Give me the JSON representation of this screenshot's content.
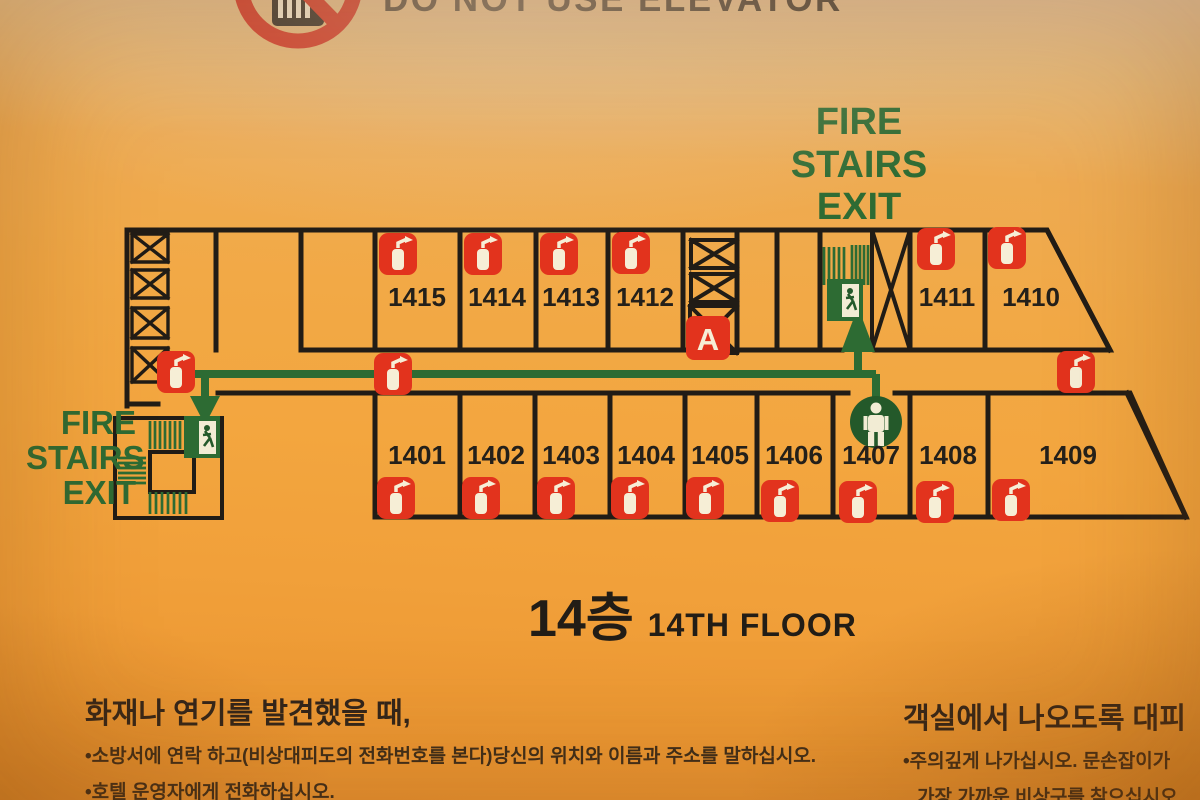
{
  "banner": {
    "text": "DO NOT USE ELEVATOR"
  },
  "exit_labels": {
    "top_right": [
      "FIRE",
      "STAIRS",
      "EXIT"
    ],
    "left": [
      "FIRE",
      "STAIRS",
      "EXIT"
    ]
  },
  "floor_title": {
    "korean": "14층",
    "english": "14TH FLOOR"
  },
  "plan": {
    "marker_a": "A",
    "rooms_top": [
      {
        "number": "1415"
      },
      {
        "number": "1414"
      },
      {
        "number": "1413"
      },
      {
        "number": "1412"
      },
      {
        "number": "1411"
      },
      {
        "number": "1410"
      }
    ],
    "rooms_bottom": [
      {
        "number": "1401"
      },
      {
        "number": "1402"
      },
      {
        "number": "1403"
      },
      {
        "number": "1404"
      },
      {
        "number": "1405"
      },
      {
        "number": "1406"
      },
      {
        "number": "1407"
      },
      {
        "number": "1408"
      },
      {
        "number": "1409"
      }
    ],
    "icons": {
      "fire_extinguisher": "fire-extinguisher-icon",
      "exit_sign": "exit-running-man-icon",
      "person": "current-location-person-icon",
      "elevator_crossed": "elevator-out-of-service-icon",
      "stairs": "stairs-icon",
      "no_elevator": "no-elevator-icon"
    },
    "colors": {
      "wall": "#211c16",
      "green": "#2d6b33",
      "red": "#e2331d",
      "person_circle": "#24592a"
    }
  },
  "instructions_left": {
    "heading": "화재나 연기를 발견했을 때,",
    "bullets": [
      "•소방서에 연락 하고(비상대피도의 전화번호를 본다)당신의 위치와 이름과 주소를 말하십시오.",
      "•호텔 운영자에게 전화하십시오."
    ]
  },
  "instructions_right": {
    "heading": "객실에서 나오도록 대피",
    "bullet_line1": "•주의깊게 나가십시오. 문손잡이가",
    "bullet_line2": "가장 가까운 비상구를 찾으십시오"
  }
}
